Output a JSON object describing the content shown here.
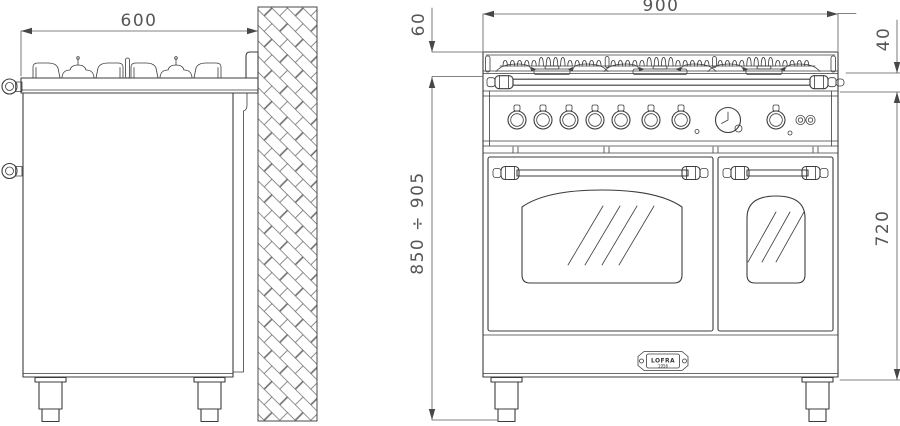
{
  "drawing": {
    "type": "range-cooker-installation-drawing",
    "views": [
      "side-elevation",
      "front-elevation"
    ],
    "colors": {
      "line": "#3c3c3c",
      "dimension": "#565656",
      "background": "#ffffff"
    }
  },
  "dimensions": {
    "depth": "600",
    "width": "900",
    "grate_height": "60",
    "rail_band": "40",
    "worktop_height_range": "850 ÷ 905",
    "body_height": "720"
  },
  "badge": {
    "brand": "LOFRA",
    "year": "1956"
  },
  "icons": {
    "timer_clock": "timer-clock-icon",
    "control_knob": "control-knob",
    "wall_hatch": "masonry-wall-hatch"
  }
}
